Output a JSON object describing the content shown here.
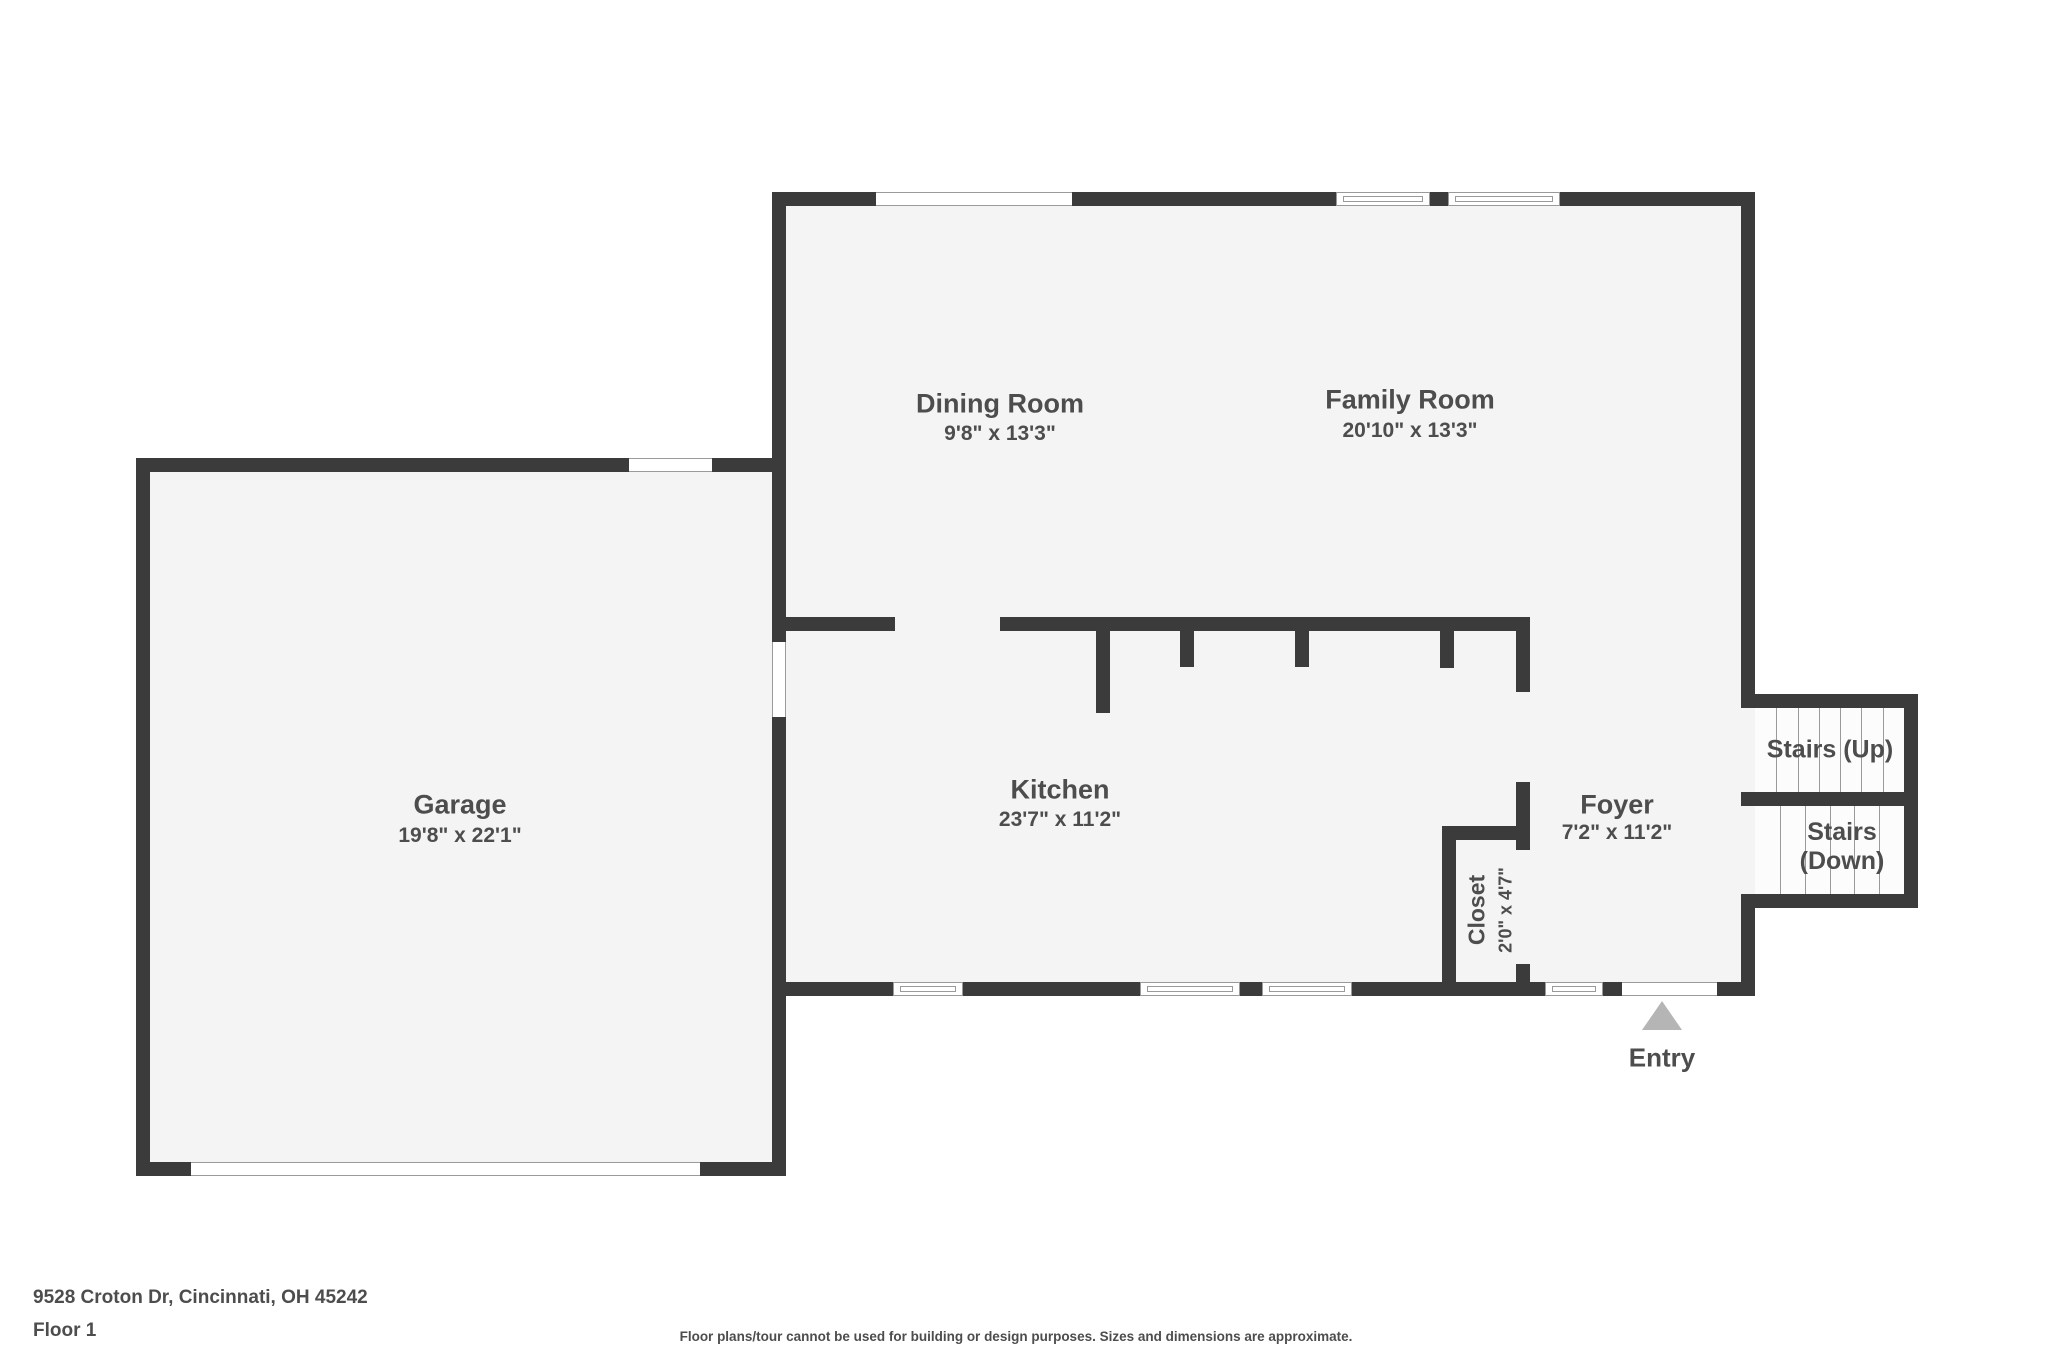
{
  "floorplan": {
    "rooms": [
      {
        "name": "Dining Room",
        "dims": "9'8\" x 13'3\""
      },
      {
        "name": "Family Room",
        "dims": "20'10\" x 13'3\""
      },
      {
        "name": "Garage",
        "dims": "19'8\" x 22'1\""
      },
      {
        "name": "Kitchen",
        "dims": "23'7\" x 11'2\""
      },
      {
        "name": "Foyer",
        "dims": "7'2\" x 11'2\""
      },
      {
        "name": "Closet",
        "dims": "2'0\" x 4'7\""
      }
    ],
    "stairs_up_label": "Stairs (Up)",
    "stairs_down_line1": "Stairs",
    "stairs_down_line2": "(Down)",
    "entry_label": "Entry"
  },
  "footer": {
    "address": "9528 Croton Dr, Cincinnati, OH 45242",
    "floor_label": "Floor 1",
    "disclaimer": "Floor plans/tour cannot be used for building or design purposes. Sizes and dimensions are approximate."
  },
  "colors": {
    "wall": "#3b3b3b",
    "floor": "#f4f4f4",
    "stair_floor": "#fcfcfc",
    "outline": "#9a9a9a",
    "text": "#4d4d4d",
    "entry_arrow": "#b5b5b5",
    "background": "#ffffff"
  }
}
